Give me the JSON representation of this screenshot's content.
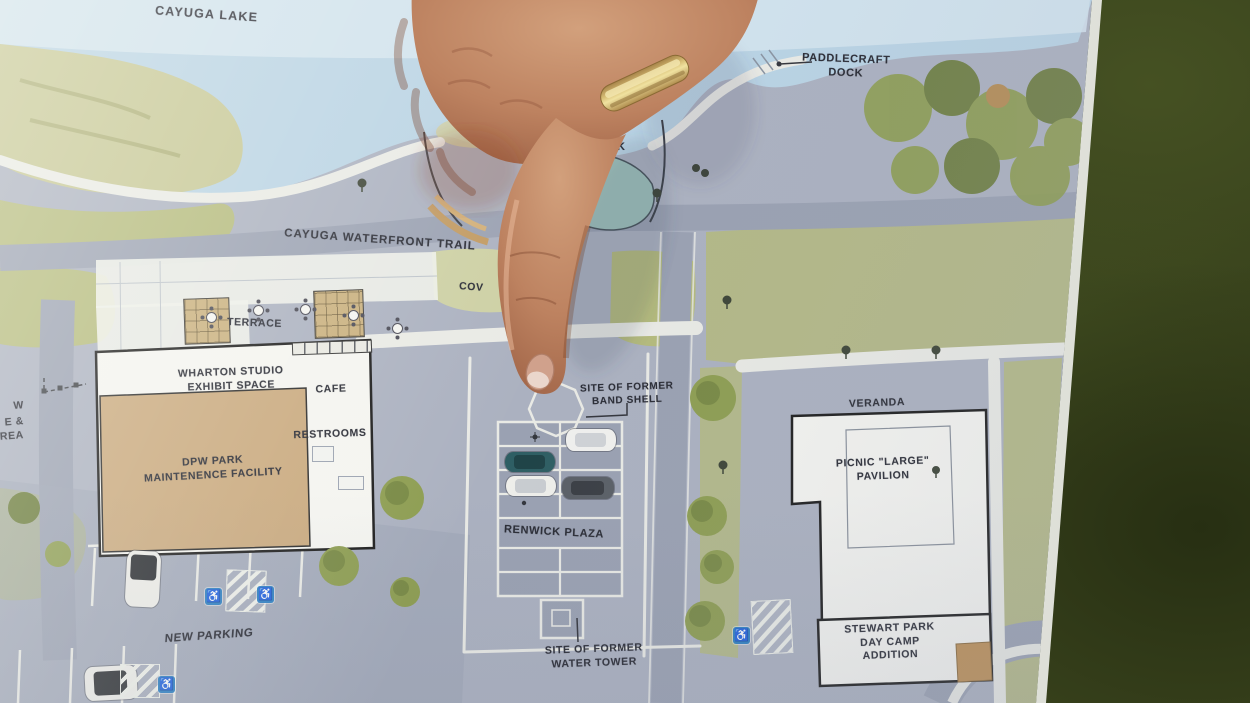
{
  "plan": {
    "labels": {
      "cayuga_lake": "CAYUGA LAKE",
      "paddlecraft_dock": "PADDLECRAFT\nDOCK",
      "waterfront_trail": "CAYUGA WATERFRONT TRAIL",
      "covered_partial": "COV",
      "k_partial": "K",
      "terrace": "TERRACE",
      "wharton_studio": "WHARTON STUDIO\nEXHIBIT SPACE",
      "cafe": "CAFE",
      "restrooms": "RESTROOMS",
      "dpw_facility": "DPW PARK\nMAINTENENCE FACILITY",
      "band_shell": "SITE OF FORMER\nBAND SHELL",
      "renwick_plaza": "RENWICK PLAZA",
      "veranda": "VERANDA",
      "picnic_pavilion": "PICNIC \"LARGE\"\nPAVILION",
      "day_camp": "STEWART PARK\nDAY CAMP\nADDITION",
      "new_parking": "NEW PARKING",
      "water_tower": "SITE OF FORMER\nWATER TOWER",
      "left_edge_line1": "W",
      "left_edge_line2": "E &",
      "left_edge_line3": "AREA"
    },
    "icons": {
      "accessible_parking": "♿"
    },
    "colors": {
      "water": "#b9d3e4",
      "water_light": "#d4e4ef",
      "marsh": "#c6c795",
      "ground": "#abb1c0",
      "road": "#9aa1b2",
      "lawn": "#b4ba7c",
      "tree": "#8d9d51",
      "tree_dark": "#6b7c3c",
      "building": "#f4f4f0",
      "tan": "#c9a97e",
      "ink": "#2a2c35",
      "outline": "#1c1c1c",
      "path": "#e9eae5",
      "blue": "#2d7fc1",
      "grass": "#3a441d",
      "skin": "#bd8260",
      "skin_dark": "#9c6044",
      "gold": "#d9c078",
      "poster": "#eef0ea"
    }
  }
}
